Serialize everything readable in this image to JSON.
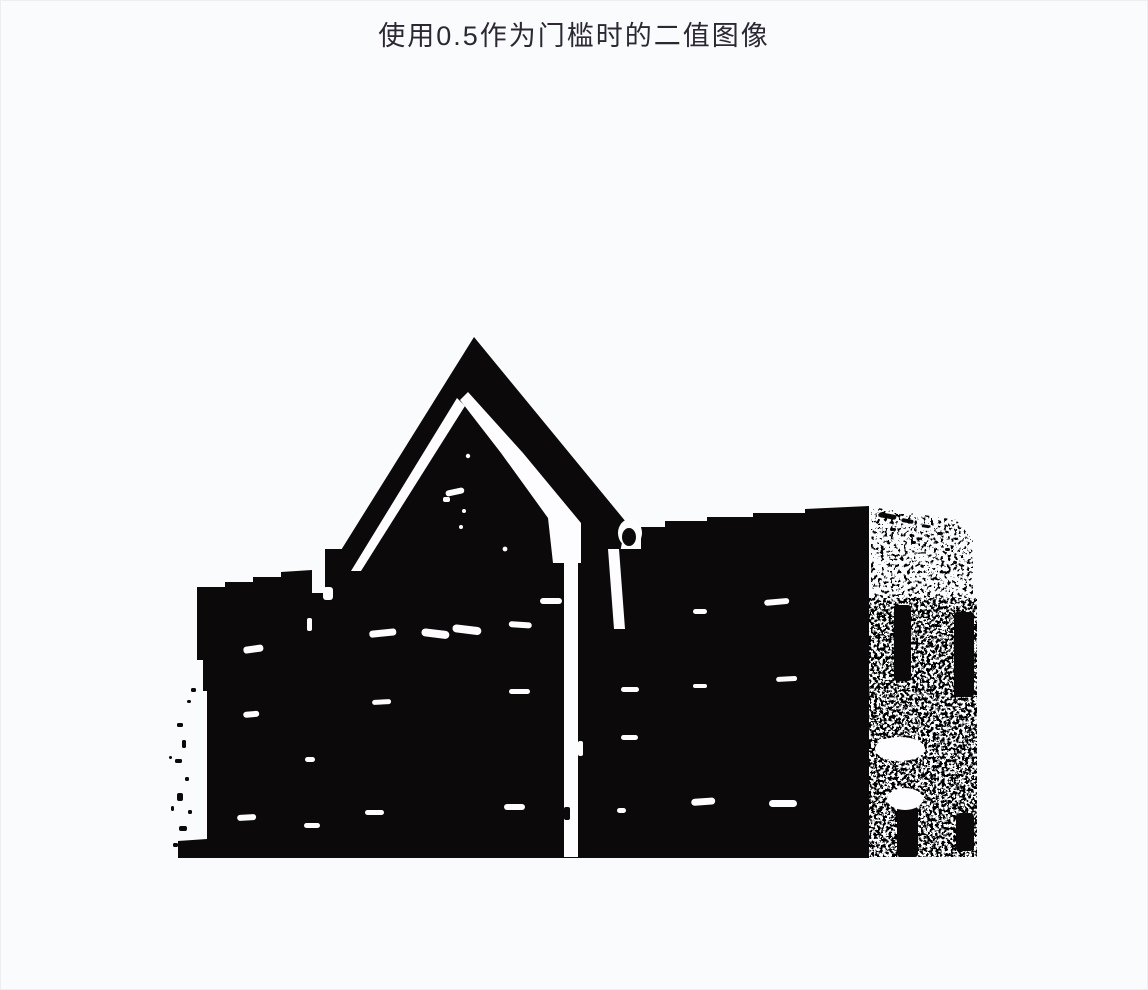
{
  "page": {
    "title": "使用0.5作为门槛时的二值图像",
    "colors": {
      "background": "#fafbfd",
      "ink": "#0b0909",
      "title": "#2b2833",
      "paper": "#fdfdff",
      "border": "#eceef4"
    }
  },
  "figure": {
    "threshold_label": "0.5",
    "content_alt": "黑白二值化的房屋图像：尖顶屋顶、黑色墙面带白色窗缝、右侧为斑点纹理砖墙"
  }
}
